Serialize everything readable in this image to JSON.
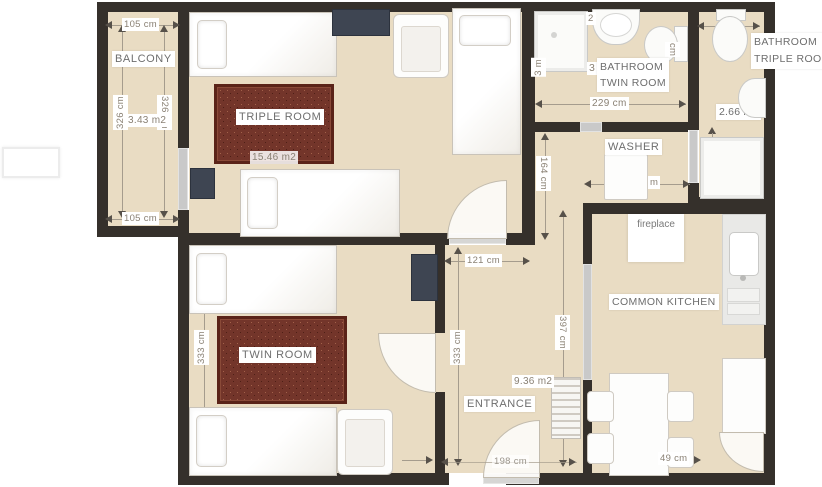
{
  "rooms": {
    "balcony": {
      "name": "BALCONY",
      "area": "3.43 m2",
      "width_top": "105 cm",
      "width_bottom": "105 cm",
      "height_left": "326 cm",
      "height_right": "326 cm"
    },
    "triple_room": {
      "name": "TRIPLE ROOM",
      "area": "15.46 m2"
    },
    "twin_room": {
      "name": "TWIN ROOM",
      "height_left": "333 cm"
    },
    "entrance": {
      "name": "ENTRANCE",
      "area": "9.36 m2",
      "width_top": "121 cm",
      "width_bottom": "198 cm",
      "height_left": "333 cm",
      "height_right": "397 cm"
    },
    "washer": {
      "name": "WASHER",
      "height_left": "164 cm",
      "width_fragment": "m"
    },
    "bathroom_twin": {
      "name_line1": "BATHROOM",
      "name_line2": "TWIN ROOM",
      "width_bottom": "229 cm",
      "area_fragment": "3",
      "top_fragment": "2",
      "left_fragment": "3 m",
      "right_fragment": "cm"
    },
    "bathroom_triple": {
      "name_line1": "BATHROOM",
      "name_line2": "TRIPLE ROOM",
      "area": "2.66 m2"
    },
    "kitchen": {
      "name": "COMMON KITCHEN",
      "fireplace": "fireplace",
      "table_width": "49 cm"
    }
  },
  "colors": {
    "wall": "#35302b",
    "floor": "#e9dcc3",
    "rug": "#73352a",
    "rug_border": "#5a2318",
    "dark_furniture": "#3e4552",
    "door_gray": "#c9c9c9",
    "dimension_line": "#a59c8d",
    "dimension_text": "#8a8174",
    "label_text": "#6e6e6e"
  }
}
